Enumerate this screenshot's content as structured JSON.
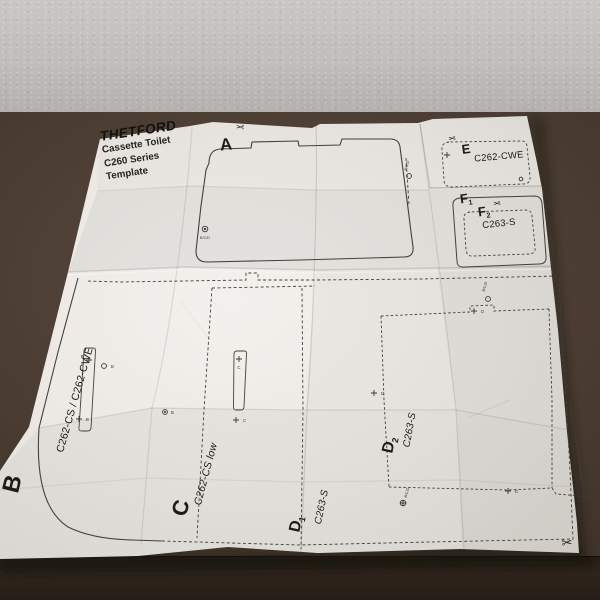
{
  "scene": {
    "description": "Unfolded paper installation template lying on a dark brown table in front of a grey plastered wall",
    "colors": {
      "wall": "#c0beba",
      "table": "#4c3e33",
      "table_front_edge": "#2e241c",
      "paper": "#edeae6",
      "print": "#44403b"
    }
  },
  "header": {
    "logo": "THETFORD",
    "subtitle_lines": [
      "Cassette Toilet",
      "C260 Series",
      "Template"
    ]
  },
  "sections": {
    "a": {
      "letter": "A"
    },
    "b": {
      "letter": "B",
      "model": "C262-CS / C262-CWE"
    },
    "c": {
      "letter": "C",
      "model": "C262-CS low"
    },
    "d1": {
      "letter": "D",
      "sub": "1",
      "model": "C263-S"
    },
    "d2": {
      "letter": "D",
      "sub": "2",
      "model": "C263-S"
    },
    "e": {
      "letter": "E",
      "model": "C262-CWE"
    },
    "f1": {
      "letter": "F",
      "sub": "1"
    },
    "f2": {
      "letter": "F",
      "sub": "2",
      "model": "C263-S"
    }
  },
  "icons": {
    "scissors": "✂"
  },
  "markers": {
    "m1": "B/C/D",
    "m4": "B",
    "m5": "B",
    "m6": "B",
    "m7": "B",
    "m8": "C",
    "m9": "C",
    "m10": "B/C/D",
    "m11": "D",
    "m12": "D",
    "m13": "B/C/D",
    "m14": "D",
    "m15": "B/C/D"
  }
}
